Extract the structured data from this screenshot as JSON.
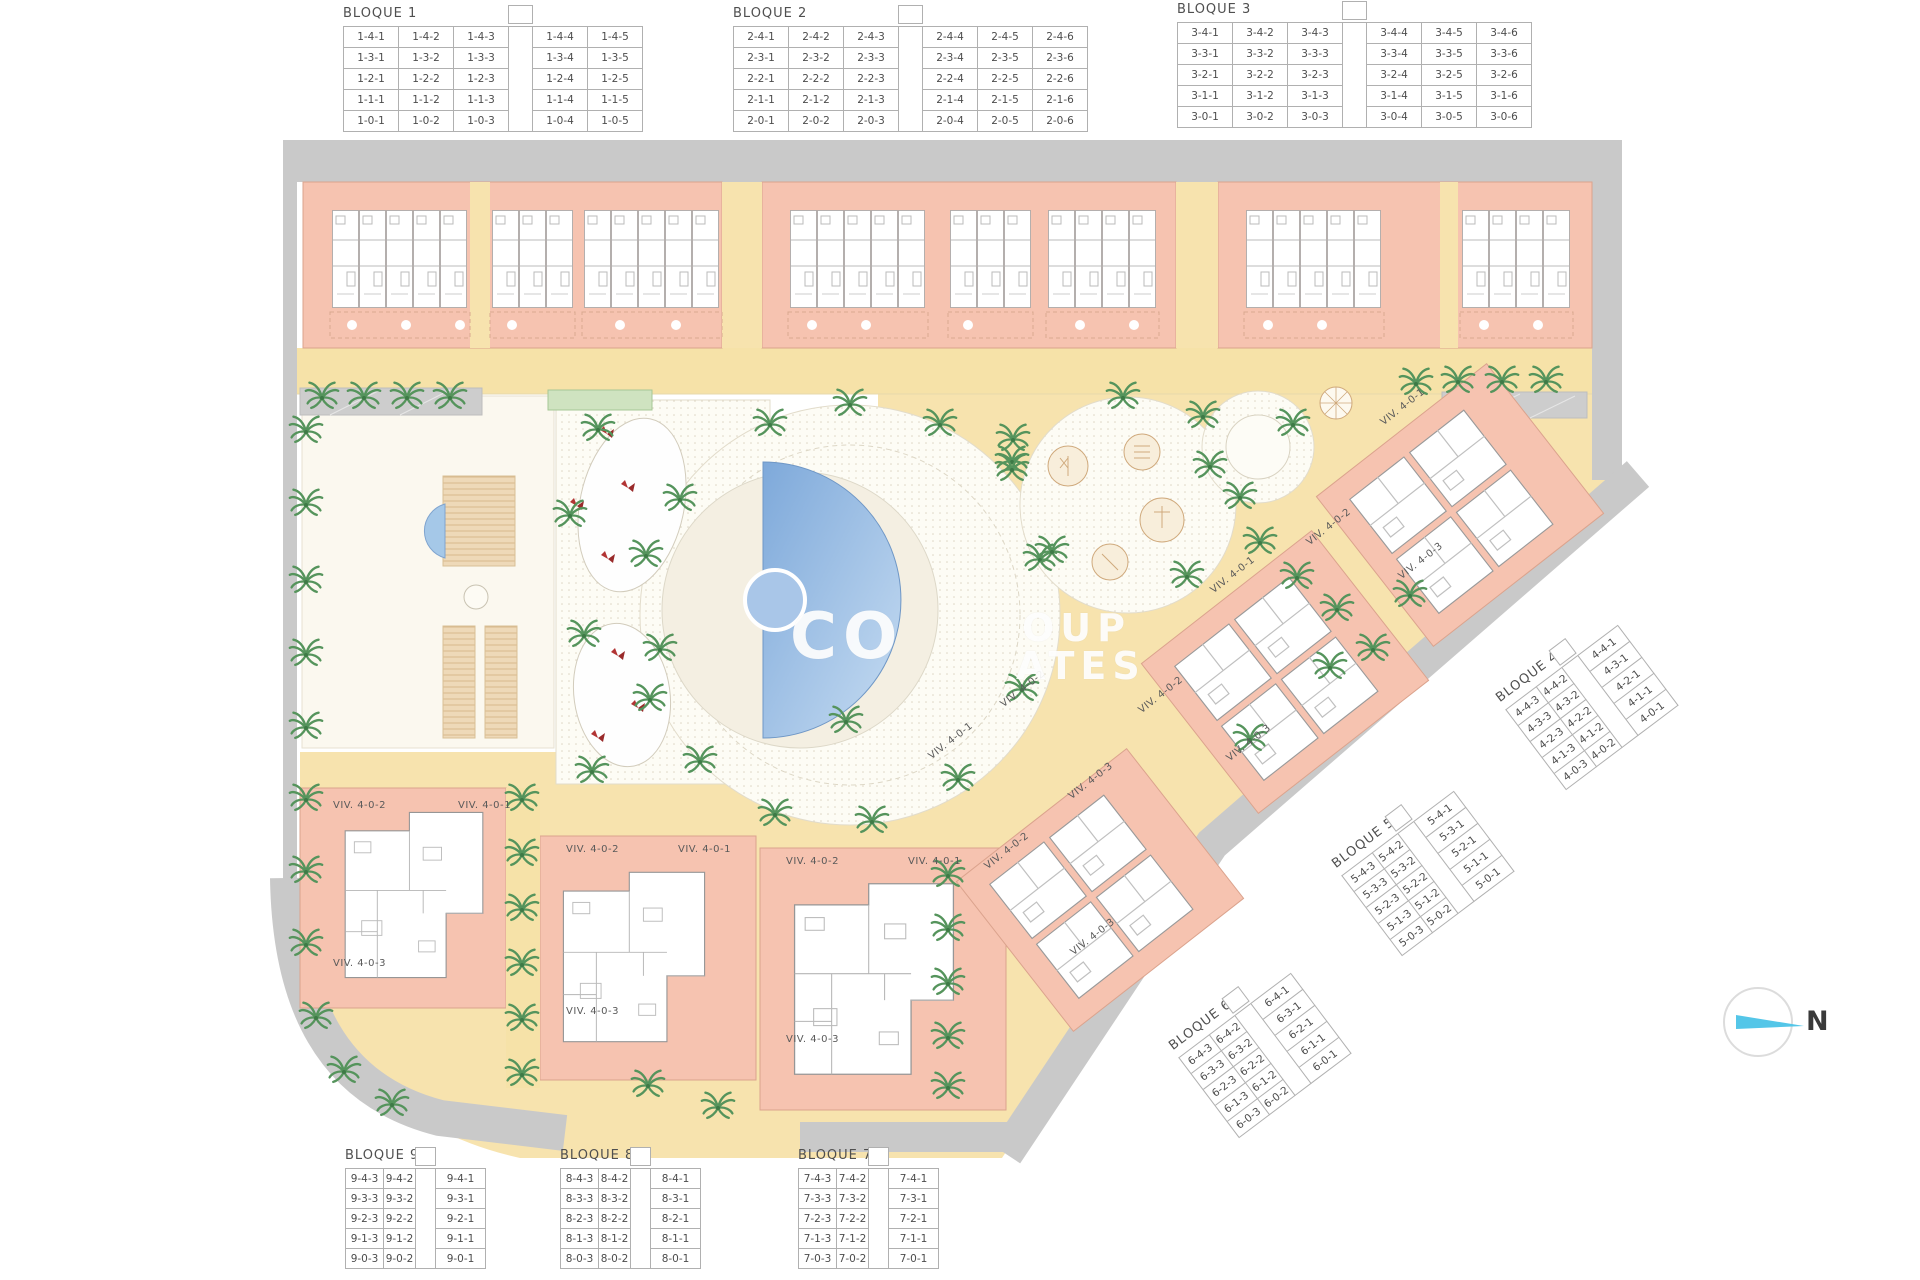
{
  "north": {
    "label": "N"
  },
  "watermark": {
    "frag1": "CO",
    "frag2": "OUP",
    "frag3": "ATES"
  },
  "colors": {
    "building": "#f6c3b0",
    "building_outline": "#dba38d",
    "path_yellow": "#f7e3ae",
    "road_gray": "#c9c9c9",
    "pool_blue": "#8fb4e0",
    "tree_green": "#55945c",
    "north_arrow_cyan": "#54c6e8"
  },
  "bloques": [
    {
      "id": "bloque-1",
      "title": "BLOQUE 1",
      "x": 343,
      "y": 4,
      "angle": 0,
      "row_h": 21,
      "gap_index": 3,
      "col_widths": [
        55,
        55,
        55,
        24,
        55,
        55
      ],
      "rows": [
        [
          "1-4-1",
          "1-4-2",
          "1-4-3",
          "",
          "1-4-4",
          "1-4-5"
        ],
        [
          "1-3-1",
          "1-3-2",
          "1-3-3",
          "",
          "1-3-4",
          "1-3-5"
        ],
        [
          "1-2-1",
          "1-2-2",
          "1-2-3",
          "",
          "1-2-4",
          "1-2-5"
        ],
        [
          "1-1-1",
          "1-1-2",
          "1-1-3",
          "",
          "1-1-4",
          "1-1-5"
        ],
        [
          "1-0-1",
          "1-0-2",
          "1-0-3",
          "",
          "1-0-4",
          "1-0-5"
        ]
      ]
    },
    {
      "id": "bloque-2",
      "title": "BLOQUE 2",
      "x": 733,
      "y": 4,
      "angle": 0,
      "row_h": 21,
      "gap_index": 3,
      "col_widths": [
        55,
        55,
        55,
        24,
        55,
        55,
        55
      ],
      "rows": [
        [
          "2-4-1",
          "2-4-2",
          "2-4-3",
          "",
          "2-4-4",
          "2-4-5",
          "2-4-6"
        ],
        [
          "2-3-1",
          "2-3-2",
          "2-3-3",
          "",
          "2-3-4",
          "2-3-5",
          "2-3-6"
        ],
        [
          "2-2-1",
          "2-2-2",
          "2-2-3",
          "",
          "2-2-4",
          "2-2-5",
          "2-2-6"
        ],
        [
          "2-1-1",
          "2-1-2",
          "2-1-3",
          "",
          "2-1-4",
          "2-1-5",
          "2-1-6"
        ],
        [
          "2-0-1",
          "2-0-2",
          "2-0-3",
          "",
          "2-0-4",
          "2-0-5",
          "2-0-6"
        ]
      ]
    },
    {
      "id": "bloque-3",
      "title": "BLOQUE 3",
      "x": 1177,
      "y": 0,
      "angle": 0,
      "row_h": 21,
      "gap_index": 3,
      "col_widths": [
        55,
        55,
        55,
        24,
        55,
        55,
        55
      ],
      "rows": [
        [
          "3-4-1",
          "3-4-2",
          "3-4-3",
          "",
          "3-4-4",
          "3-4-5",
          "3-4-6"
        ],
        [
          "3-3-1",
          "3-3-2",
          "3-3-3",
          "",
          "3-3-4",
          "3-3-5",
          "3-3-6"
        ],
        [
          "3-2-1",
          "3-2-2",
          "3-2-3",
          "",
          "3-2-4",
          "3-2-5",
          "3-2-6"
        ],
        [
          "3-1-1",
          "3-1-2",
          "3-1-3",
          "",
          "3-1-4",
          "3-1-5",
          "3-1-6"
        ],
        [
          "3-0-1",
          "3-0-2",
          "3-0-3",
          "",
          "3-0-4",
          "3-0-5",
          "3-0-6"
        ]
      ]
    },
    {
      "id": "bloque-4",
      "title": "BLOQUE 4",
      "x": 1492,
      "y": 692,
      "angle": -37,
      "row_h": 20,
      "gap_index": 2,
      "col_widths": [
        38,
        32,
        20,
        50
      ],
      "rows": [
        [
          "4-4-3",
          "4-4-2",
          "",
          "4-4-1"
        ],
        [
          "4-3-3",
          "4-3-2",
          "",
          "4-3-1"
        ],
        [
          "4-2-3",
          "4-2-2",
          "",
          "4-2-1"
        ],
        [
          "4-1-3",
          "4-1-2",
          "",
          "4-1-1"
        ],
        [
          "4-0-3",
          "4-0-2",
          "",
          "4-0-1"
        ]
      ]
    },
    {
      "id": "bloque-5",
      "title": "BLOQUE 5",
      "x": 1328,
      "y": 858,
      "angle": -37,
      "row_h": 20,
      "gap_index": 2,
      "col_widths": [
        38,
        32,
        20,
        50
      ],
      "rows": [
        [
          "5-4-3",
          "5-4-2",
          "",
          "5-4-1"
        ],
        [
          "5-3-3",
          "5-3-2",
          "",
          "5-3-1"
        ],
        [
          "5-2-3",
          "5-2-2",
          "",
          "5-2-1"
        ],
        [
          "5-1-3",
          "5-1-2",
          "",
          "5-1-1"
        ],
        [
          "5-0-3",
          "5-0-2",
          "",
          "5-0-1"
        ]
      ]
    },
    {
      "id": "bloque-6",
      "title": "BLOQUE 6",
      "x": 1165,
      "y": 1040,
      "angle": -37,
      "row_h": 20,
      "gap_index": 2,
      "col_widths": [
        38,
        32,
        20,
        50
      ],
      "rows": [
        [
          "6-4-3",
          "6-4-2",
          "",
          "6-4-1"
        ],
        [
          "6-3-3",
          "6-3-2",
          "",
          "6-3-1"
        ],
        [
          "6-2-3",
          "6-2-2",
          "",
          "6-2-1"
        ],
        [
          "6-1-3",
          "6-1-2",
          "",
          "6-1-1"
        ],
        [
          "6-0-3",
          "6-0-2",
          "",
          "6-0-1"
        ]
      ]
    },
    {
      "id": "bloque-9",
      "title": "BLOQUE 9",
      "x": 345,
      "y": 1146,
      "angle": 0,
      "row_h": 20,
      "gap_index": 2,
      "col_widths": [
        38,
        32,
        20,
        50
      ],
      "rows": [
        [
          "9-4-3",
          "9-4-2",
          "",
          "9-4-1"
        ],
        [
          "9-3-3",
          "9-3-2",
          "",
          "9-3-1"
        ],
        [
          "9-2-3",
          "9-2-2",
          "",
          "9-2-1"
        ],
        [
          "9-1-3",
          "9-1-2",
          "",
          "9-1-1"
        ],
        [
          "9-0-3",
          "9-0-2",
          "",
          "9-0-1"
        ]
      ]
    },
    {
      "id": "bloque-8",
      "title": "BLOQUE 8",
      "x": 560,
      "y": 1146,
      "angle": 0,
      "row_h": 20,
      "gap_index": 2,
      "col_widths": [
        38,
        32,
        20,
        50
      ],
      "rows": [
        [
          "8-4-3",
          "8-4-2",
          "",
          "8-4-1"
        ],
        [
          "8-3-3",
          "8-3-2",
          "",
          "8-3-1"
        ],
        [
          "8-2-3",
          "8-2-2",
          "",
          "8-2-1"
        ],
        [
          "8-1-3",
          "8-1-2",
          "",
          "8-1-1"
        ],
        [
          "8-0-3",
          "8-0-2",
          "",
          "8-0-1"
        ]
      ]
    },
    {
      "id": "bloque-7",
      "title": "BLOQUE 7",
      "x": 798,
      "y": 1146,
      "angle": 0,
      "row_h": 20,
      "gap_index": 2,
      "col_widths": [
        38,
        32,
        20,
        50
      ],
      "rows": [
        [
          "7-4-3",
          "7-4-2",
          "",
          "7-4-1"
        ],
        [
          "7-3-3",
          "7-3-2",
          "",
          "7-3-1"
        ],
        [
          "7-2-3",
          "7-2-2",
          "",
          "7-2-1"
        ],
        [
          "7-1-3",
          "7-1-2",
          "",
          "7-1-1"
        ],
        [
          "7-0-3",
          "7-0-2",
          "",
          "7-0-1"
        ]
      ]
    }
  ],
  "viv_labels": [
    {
      "text": "VIV. 4-0-2",
      "x": 333,
      "y": 800,
      "angle": 0
    },
    {
      "text": "VIV. 4-0-1",
      "x": 458,
      "y": 800,
      "angle": 0
    },
    {
      "text": "VIV. 4-0-3",
      "x": 333,
      "y": 958,
      "angle": 0
    },
    {
      "text": "VIV. 4-0-2",
      "x": 566,
      "y": 844,
      "angle": 0
    },
    {
      "text": "VIV. 4-0-1",
      "x": 678,
      "y": 844,
      "angle": 0
    },
    {
      "text": "VIV. 4-0-3",
      "x": 566,
      "y": 1006,
      "angle": 0
    },
    {
      "text": "VIV. 4-0-2",
      "x": 786,
      "y": 856,
      "angle": 0
    },
    {
      "text": "VIV. 4-0-1",
      "x": 908,
      "y": 856,
      "angle": 0
    },
    {
      "text": "VIV. 4-0-3",
      "x": 786,
      "y": 1034,
      "angle": 0
    },
    {
      "text": "VIV. 4-0-1",
      "x": 1382,
      "y": 418,
      "angle": -38
    },
    {
      "text": "VIV. 4-0-2",
      "x": 1308,
      "y": 538,
      "angle": -38
    },
    {
      "text": "VIV. 4-0-3",
      "x": 1400,
      "y": 572,
      "angle": -38
    },
    {
      "text": "VIV. 4-0-1",
      "x": 1212,
      "y": 586,
      "angle": -38
    },
    {
      "text": "VIV. 4-0-2",
      "x": 1140,
      "y": 706,
      "angle": -38
    },
    {
      "text": "VIV. 4-0-3",
      "x": 1228,
      "y": 754,
      "angle": -38
    },
    {
      "text": "VIV. 4-0-1",
      "x": 930,
      "y": 752,
      "angle": -38
    },
    {
      "text": "VIV. 4-0-2",
      "x": 1002,
      "y": 700,
      "angle": -38
    },
    {
      "text": "VIV. 4-0-3",
      "x": 1070,
      "y": 792,
      "angle": -38
    },
    {
      "text": "VIV. 4-0-2",
      "x": 986,
      "y": 862,
      "angle": -38
    },
    {
      "text": "VIV. 4-0-3",
      "x": 1072,
      "y": 948,
      "angle": -38
    }
  ]
}
